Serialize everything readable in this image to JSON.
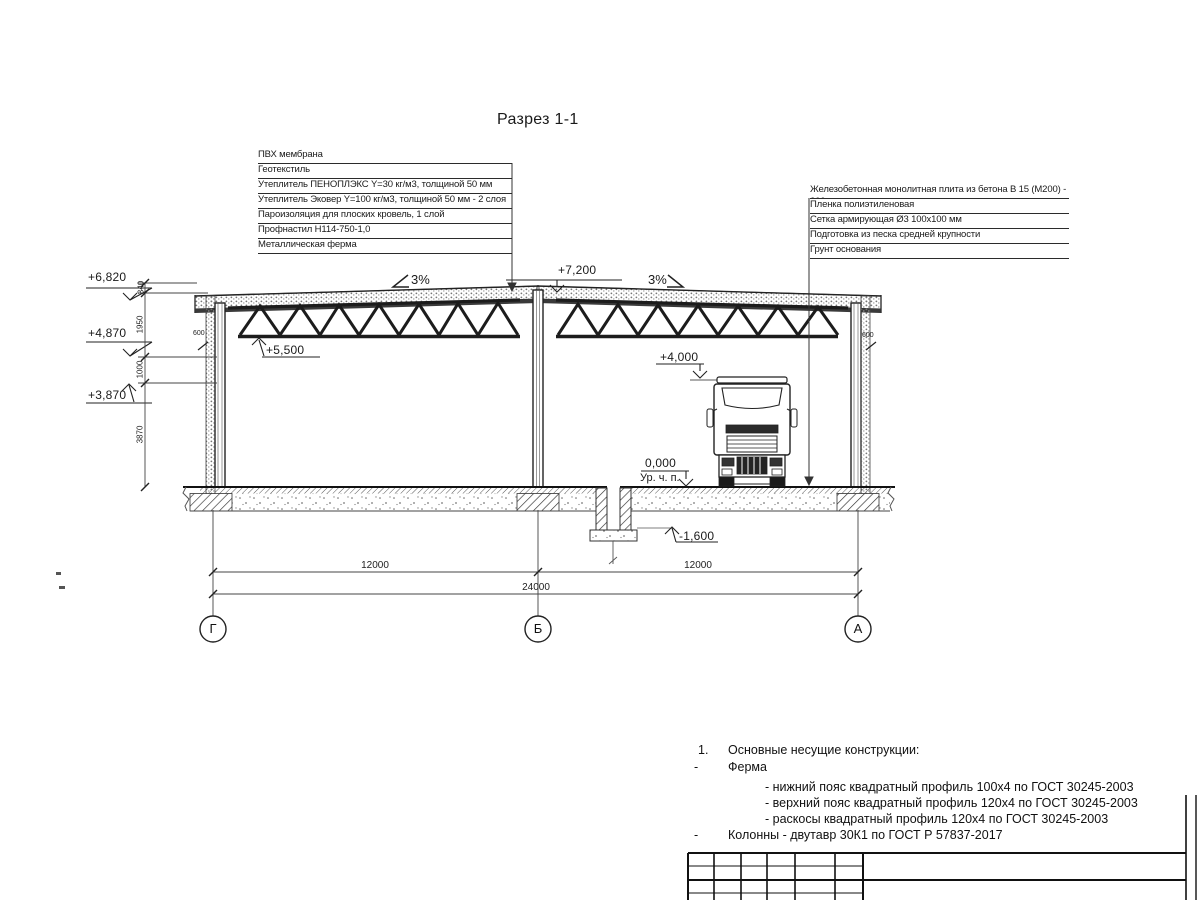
{
  "title": "Разрез 1-1",
  "roof_callouts": {
    "items": [
      "ПВХ мембрана",
      "Геотекстиль",
      "Утеплитель ПЕНОПЛЭКС Y=30 кг/м3, толщиной 50 мм",
      "Утеплитель Эковер Y=100 кг/м3, толщиной 50 мм - 2 слоя",
      "Пароизоляция для плоских кровель, 1 слой",
      "Профнастил Н114-750-1,0",
      "Металлическая ферма"
    ]
  },
  "floor_callouts": {
    "items": [
      "Железобетонная монолитная плита из бетона В 15 (М200) - 200 мм",
      "Пленка полиэтиленовая",
      "Сетка армирующая Ø3 100х100 мм",
      "Подготовка из песка средней крупности",
      "Грунт основания"
    ]
  },
  "elevations": {
    "eave_left": "+6,820",
    "truss_support": "+4,870",
    "wall_top": "+3,870",
    "ridge": "+7,200",
    "truss_bottom": "+5,500",
    "clearance": "+4,000",
    "floor": "0,000",
    "floor_note": "Ур. ч. п.",
    "pit": "-1,600"
  },
  "slopes": {
    "left": "3%",
    "right": "3%"
  },
  "dimensions": {
    "left_chain": [
      "340",
      "1950",
      "1000",
      "3870"
    ],
    "bay_left": "12000",
    "bay_right": "12000",
    "total": "24000",
    "parapet_left": "600",
    "parapet_right": "600"
  },
  "axes": [
    "Г",
    "Б",
    "А"
  ],
  "notes": {
    "number": "1.",
    "heading": "Основные несущие конструкции:",
    "bullet1": "-",
    "truss_label": "Ферма",
    "truss_items": [
      "- нижний пояс квадратный профиль 100х4 по ГОСТ 30245-2003",
      "- верхний пояс квадратный профиль 120х4 по ГОСТ 30245-2003",
      "- раскосы квадратный профиль 120х4 по ГОСТ 30245-2003"
    ],
    "bullet2": "-",
    "columns_item": "Колонны - двутавр 30К1 по ГОСТ Р 57837-2017"
  }
}
